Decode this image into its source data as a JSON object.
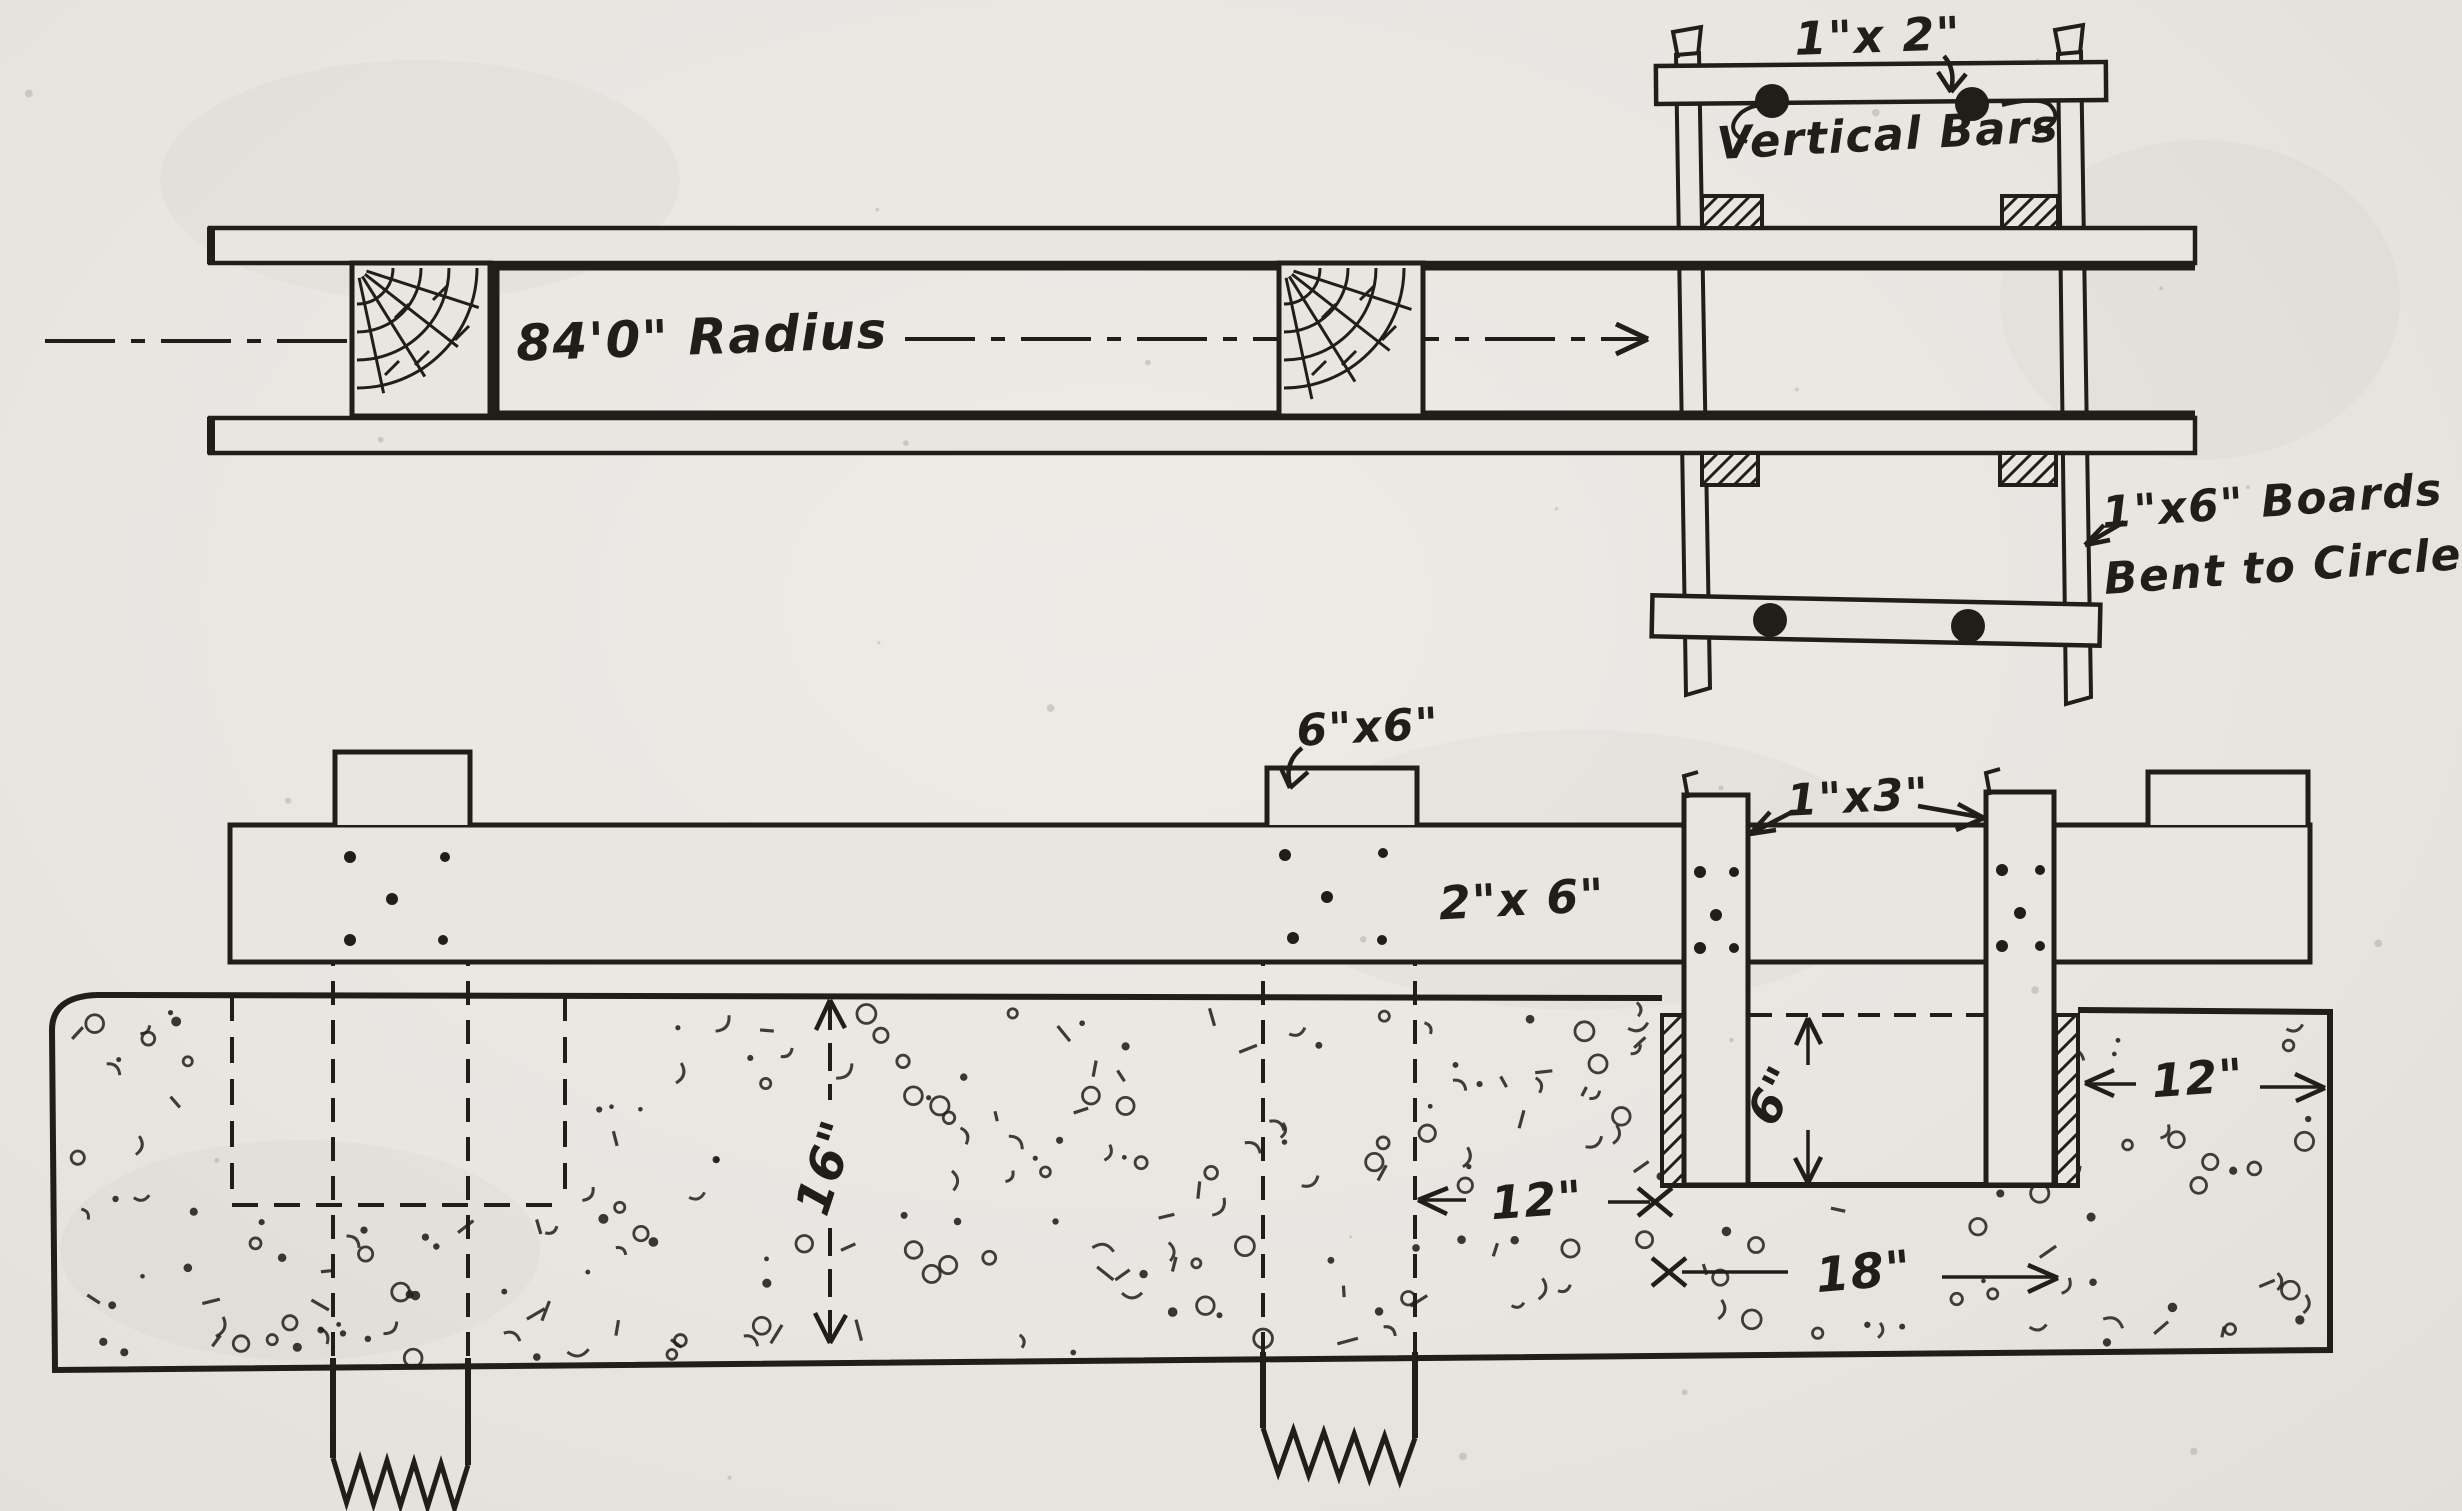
{
  "colors": {
    "paper": "#e8e6e1",
    "ink": "#211e1a"
  },
  "plan_view": {
    "radius_label": "84'0\" Radius",
    "batten_label": "1\"x 2\"",
    "vertical_bars_label": "Vertical Bars",
    "bent_boards_label_1": "1\"x6\" Boards",
    "bent_boards_label_2": "Bent to Circle"
  },
  "section_view": {
    "post_label": "6\"x6\"",
    "wale_label": "2\"x 6\"",
    "strip_label": "1\"x3\"",
    "dim_slab_depth": "16\"",
    "dim_curb_depth": "6\"",
    "dim_inner_offset": "12\"",
    "dim_channel_width": "18\"",
    "dim_outer_offset": "12\""
  }
}
